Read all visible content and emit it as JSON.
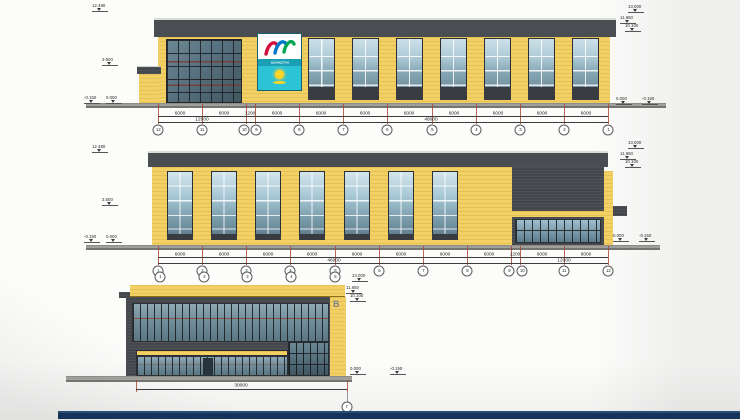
{
  "colors": {
    "facade_yellow": "#f2d063",
    "facade_dark": "#44484c",
    "glass_blue": "#9dbecb",
    "dimension_red": "#a8402f",
    "footer_navy": "#16335a",
    "logo_teal": "#2cc3d7"
  },
  "logo": {
    "country_label": "ҚАЗАҚСТАН"
  },
  "levels": {
    "peak": "13.000",
    "upper_a": "11.650",
    "upper_b": "10.100",
    "parapet": "12.480",
    "mid": "3.500",
    "zero": "0.000",
    "below": "-0.150"
  },
  "elev_top": {
    "axes": [
      "12",
      "11",
      "10",
      "9",
      "8",
      "7",
      "6",
      "5",
      "4",
      "3",
      "2",
      "1"
    ],
    "dims": [
      "6000",
      "6000",
      "1200",
      "6000",
      "6000",
      "6000",
      "6000",
      "6000",
      "6000",
      "6000",
      "6000"
    ],
    "totals": [
      "12000",
      "48000"
    ]
  },
  "elev_mid": {
    "axes": [
      "1",
      "2",
      "3",
      "4",
      "5",
      "6",
      "7",
      "8",
      "9",
      "10",
      "11",
      "12"
    ],
    "dims": [
      "6000",
      "6000",
      "6000",
      "6000",
      "6000",
      "6000",
      "6000",
      "6000",
      "1200",
      "6000",
      "6000"
    ],
    "totals": [
      "48000",
      "12000"
    ]
  },
  "elev_front": {
    "axes": [
      "1",
      "2",
      "3",
      "4",
      "5"
    ],
    "total": "30000",
    "corner_letter": "В",
    "end_axis_letter": "Г"
  }
}
